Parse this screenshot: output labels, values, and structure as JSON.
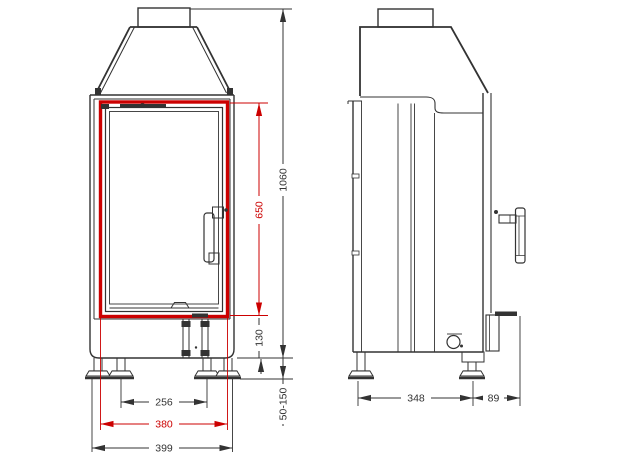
{
  "colors": {
    "highlight": "#cc0000",
    "line": "#333333"
  },
  "dimensions": {
    "door_opening_height": "650",
    "overall_height": "1060",
    "plinth_height": "130",
    "leg_adjustment_range": "50-150",
    "inner_feet_spacing": "256",
    "door_opening_width": "380",
    "overall_width": "399",
    "body_depth": "348",
    "rear_projection": "89"
  }
}
